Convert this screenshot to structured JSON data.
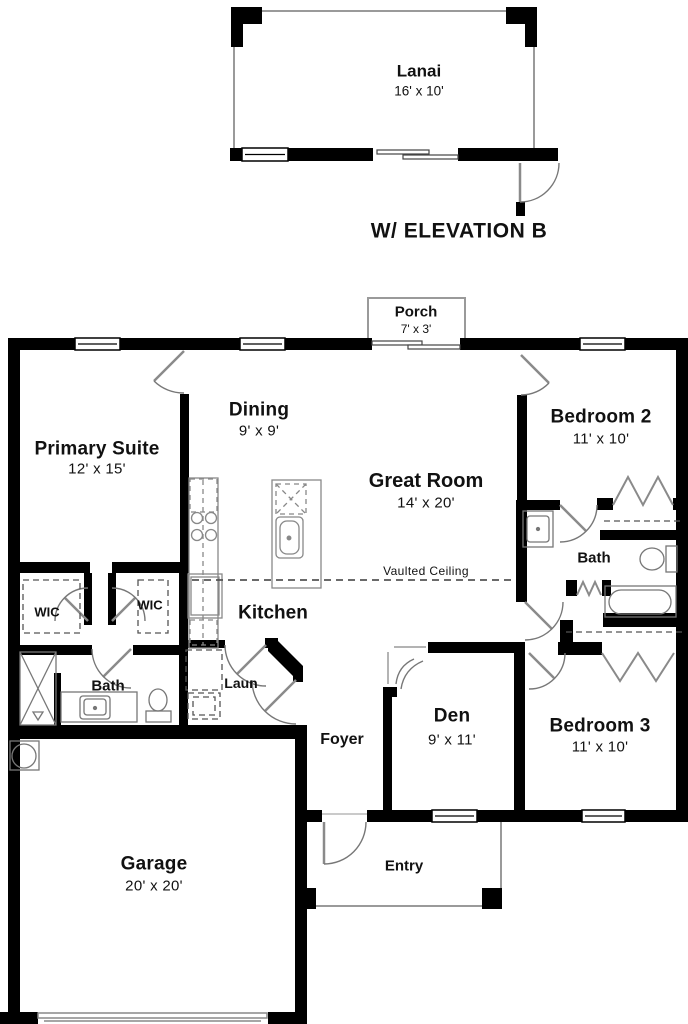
{
  "floorplan": {
    "elevation_label": "W/ ELEVATION B",
    "annotations": {
      "vaulted_ceiling": "Vaulted Ceiling"
    },
    "colors": {
      "walls": "#000000",
      "background": "#ffffff",
      "thin_lines": "#8a8a8a"
    },
    "rooms": {
      "lanai": {
        "name": "Lanai",
        "dims": "16' x 10'"
      },
      "porch": {
        "name": "Porch",
        "dims": "7' x 3'"
      },
      "dining": {
        "name": "Dining",
        "dims": "9' x 9'"
      },
      "primary_suite": {
        "name": "Primary Suite",
        "dims": "12' x 15'"
      },
      "great_room": {
        "name": "Great Room",
        "dims": "14' x 20'"
      },
      "bedroom2": {
        "name": "Bedroom 2",
        "dims": "11' x 10'"
      },
      "bedroom3": {
        "name": "Bedroom 3",
        "dims": "11' x 10'"
      },
      "den": {
        "name": "Den",
        "dims": "9' x 11'"
      },
      "garage": {
        "name": "Garage",
        "dims": "20' x 20'"
      },
      "kitchen": {
        "name": "Kitchen"
      },
      "foyer": {
        "name": "Foyer"
      },
      "entry": {
        "name": "Entry"
      },
      "laundry": {
        "name": "Laun"
      },
      "primary_bath": {
        "name": "Bath"
      },
      "hall_bath": {
        "name": "Bath"
      },
      "wic_1": {
        "name": "WIC"
      },
      "wic_2": {
        "name": "WIC"
      }
    }
  }
}
